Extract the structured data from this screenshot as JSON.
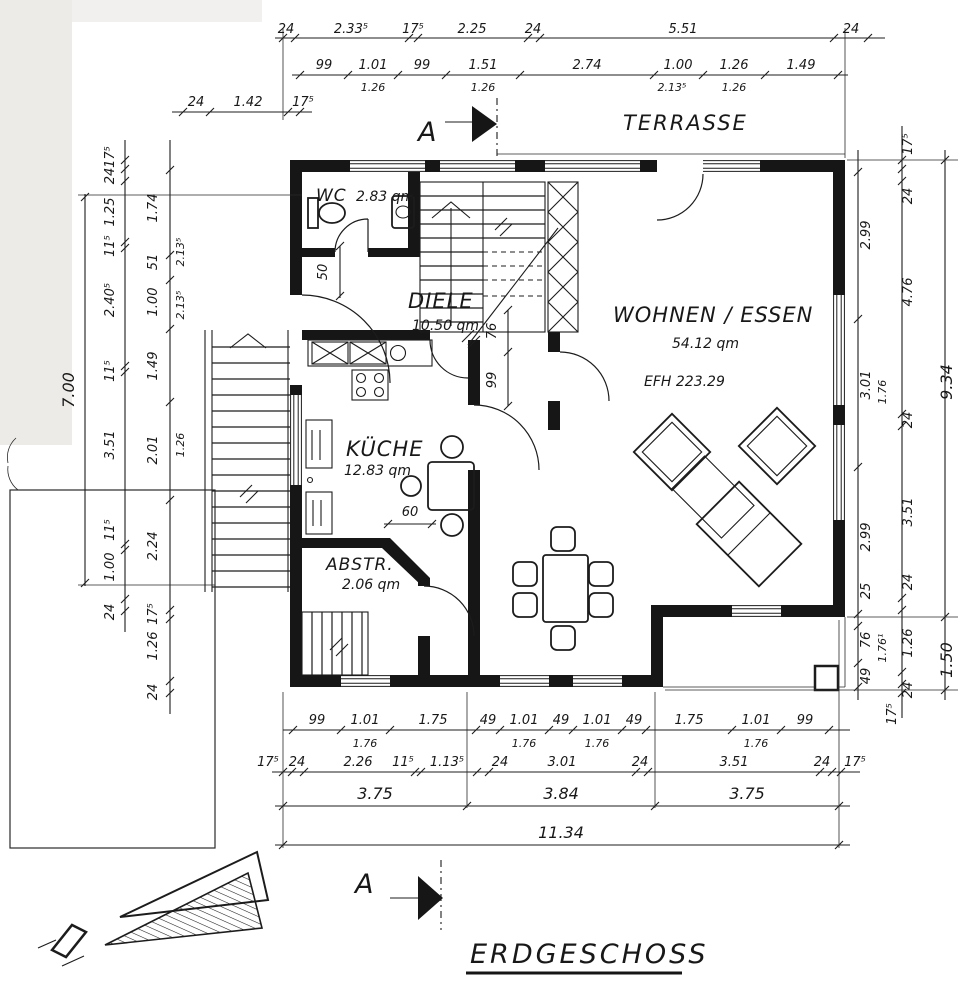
{
  "title": "ERDGESCHOSS",
  "terrace": "TERRASSE",
  "section": {
    "label": "A"
  },
  "rooms": {
    "wc": {
      "name": "WC",
      "area": "2.83 qm"
    },
    "diele": {
      "name": "DIELE",
      "area": "10.50 qm"
    },
    "wohnen": {
      "name": "WOHNEN / ESSEN",
      "area": "54.12 qm",
      "efh": "EFH  223.29"
    },
    "kueche": {
      "name": "KÜCHE",
      "area": "12.83 qm"
    },
    "abstell": {
      "name": "ABSTR.",
      "area": "2.06 qm"
    }
  },
  "dims": {
    "top1": [
      "24",
      "2.33⁵",
      "17⁵",
      "2.25",
      "24",
      "5.51",
      "24"
    ],
    "top2": [
      "99",
      "1.01",
      "99",
      "1.51",
      "2.74",
      "1.00",
      "1.26",
      "1.49"
    ],
    "top2sub": [
      "1.26",
      "1.26",
      "2.13⁵",
      "1.26"
    ],
    "lefttop": [
      "24",
      "1.42",
      "17⁵"
    ],
    "left0": "7.00",
    "left1": [
      "17⁵",
      "24",
      "1.25",
      "11⁵",
      "2.40⁵",
      "11⁵",
      "3.51",
      "11⁵",
      "1.00",
      "24"
    ],
    "left2": [
      "1.74",
      "51",
      "1.00",
      "1.49",
      "2.01",
      "2.24",
      "17⁵",
      "1.26",
      "24"
    ],
    "left2sub": [
      "2.13⁵",
      "2.13⁵",
      "1.26"
    ],
    "right1": [
      "2.99",
      "3.01",
      "2.99",
      "25",
      "76",
      "49"
    ],
    "right1sub": [
      "1.76",
      "1.76¹"
    ],
    "right2": [
      "17⁵",
      "24",
      "4.76",
      "24",
      "3.51",
      "24",
      "1.26",
      "24",
      "17⁵"
    ],
    "right3": [
      "9.34",
      "1.50"
    ],
    "bottom1": [
      "99",
      "1.01",
      "1.75",
      "49",
      "1.01",
      "49",
      "1.01",
      "49",
      "1.75",
      "1.01",
      "99"
    ],
    "bottom1sub": [
      "1.76",
      "1.76",
      "1.76",
      "1.76"
    ],
    "bottom2": [
      "17⁵",
      "24",
      "2.26",
      "11⁵",
      "1.13⁵",
      "24",
      "3.01",
      "24",
      "3.51",
      "24",
      "17⁵"
    ],
    "bottom3": [
      "3.75",
      "3.84",
      "3.75"
    ],
    "total": "11.34",
    "inner": {
      "d50": "50",
      "d76": "76",
      "d99": "99",
      "d60": "60"
    }
  }
}
